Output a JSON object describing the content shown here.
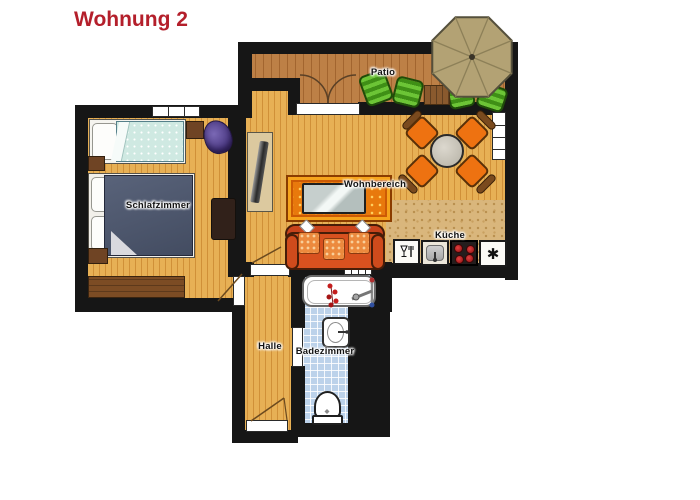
{
  "title": "Wohnung 2",
  "floorplan": {
    "rooms": [
      {
        "id": "schlafzimmer",
        "label": "Schlafzimmer"
      },
      {
        "id": "wohnbereich",
        "label": "Wohnbereich"
      },
      {
        "id": "kueche",
        "label": "Küche"
      },
      {
        "id": "halle",
        "label": "Halle"
      },
      {
        "id": "badezimmer",
        "label": "Badezimmer"
      },
      {
        "id": "patio",
        "label": "Patio"
      }
    ],
    "icons": {
      "freezer": "✱",
      "dishwasher": "wine-glass-and-fork",
      "stove": "four-red-burners",
      "sink": "basin-with-faucet"
    },
    "colors": {
      "title": "#b41f2b",
      "wall": "#161616",
      "wood_floor": "#e7b055",
      "patio_deck": "#bd8046",
      "bath_tile": "#bcd2ea",
      "rug": "#e8790c",
      "sofa": "#d8511f",
      "dining_chair": "#ee7211",
      "lounger_green": "#6cc436",
      "umbrella": "#b3a274",
      "stove_burner": "#c22020",
      "purple_chair": "#5a4590",
      "navy_blanket": "#4b5569",
      "teal_blanket": "#cfe9e2"
    }
  }
}
